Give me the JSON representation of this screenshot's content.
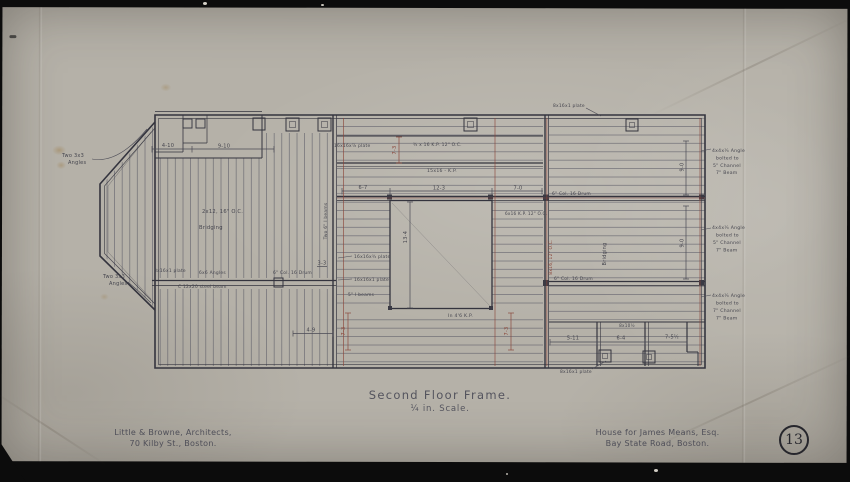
{
  "sheet": {
    "number": "13"
  },
  "title_block": {
    "title": "Second Floor Frame.",
    "scale": "¼ in. Scale.",
    "architect_line1": "Little & Browne, Architects,",
    "architect_line2": "70 Kilby St., Boston.",
    "client_line1": "House for James Means, Esq.",
    "client_line2": "Bay State Road, Boston."
  },
  "annotations": {
    "left": {
      "angles_top_1": "Two 3x3",
      "angles_top_2": "Angles",
      "angles_bot_1": "Two 3x3",
      "angles_bot_2": "Angles",
      "dim_4_10": "4-10",
      "dim_9_10": "9-10",
      "joists": "2x12, 16\" O.C.",
      "bridging": "Bridging",
      "plate": "8x16x1 plate",
      "angles_6x6": "6x6 Angles",
      "steel_beam": "C 12x20 steel beam",
      "col_drum": "6\" Col. 16 Drum",
      "dim_3_3": "3-3"
    },
    "middle": {
      "plate_78": "16x16x⅞ plate",
      "kp_top": "¾ x 16 K.P. 12\" O.C.",
      "kp_mid": "15x16 - K.P.",
      "dim_6_7": "6-7",
      "dim_12_3": "12-3",
      "dim_7_0": "7-0",
      "dim_13_4": "13-4",
      "kp_right": "6x16 K.P. 12\" O.C.",
      "kp_bottom": "In 4'6 K.P.",
      "plate_34": "16x16x¾ plate",
      "plate_1": "16x16x1 plate",
      "ibeams_5": "5\" I beams",
      "ibeams_two6": "Two 6\" I beams",
      "dim_4_9": "4-9",
      "dim_7_3": "7-3"
    },
    "right": {
      "plate_top": "8x16x1 plate",
      "col_drum_top": "6\" Col. 16 Drum",
      "col_drum_bot": "6\" Col. 16 Drum",
      "bridging": "Bridging",
      "joists": "8x16, 12\" O.C.",
      "dim_9_0": "9-0",
      "dim_5_11": "5-11",
      "dim_6_4": "6-4",
      "dim_7_5": "7-5½",
      "dim_8_10": "8x10½",
      "plate_bot": "8x16x1 plate"
    },
    "margin_right": [
      {
        "l1": "4x4x¼ Angle",
        "l2": "bolted to",
        "l3": "5\" Channel",
        "l4": "7\" Beam"
      },
      {
        "l1": "4x4x¼ Angle",
        "l2": "bolted to",
        "l3": "5\" Channel",
        "l4": "7\" Beam"
      },
      {
        "l1": "4x4x¼ Angle",
        "l2": "bolted to",
        "l3": "7\" Channel",
        "l4": "7\" Beam"
      }
    ]
  }
}
